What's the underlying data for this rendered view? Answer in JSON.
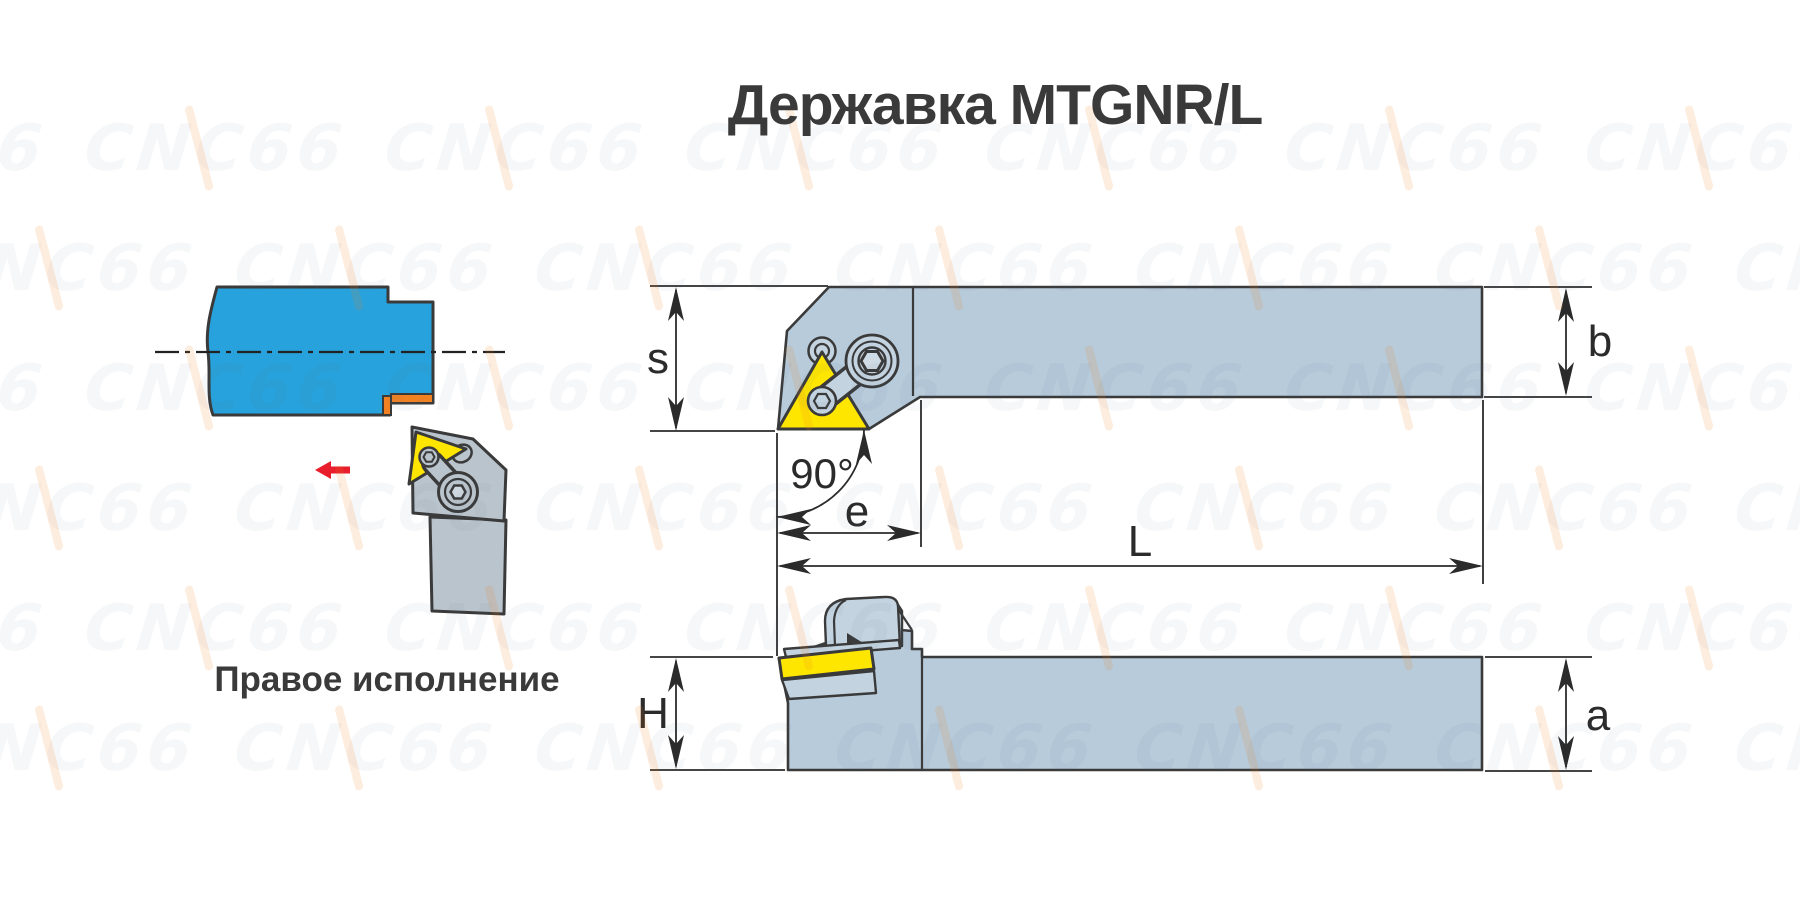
{
  "title": "Державка MTGNR/L",
  "caption": "Правое исполнение",
  "watermark": {
    "text": "CNC66"
  },
  "labels": {
    "s": "s",
    "b": "b",
    "angle": "90°",
    "e": "e",
    "L": "L",
    "H": "H",
    "a": "a"
  },
  "colors": {
    "outline": "#3a3a3a",
    "dim": "#2b2b2b",
    "drawing_fill": "#b7cbdb",
    "drawing_fill2": "#c3d3e0",
    "tool_gray": "#bac4cd",
    "workpiece_blue": "#27a2dc",
    "chip_orange": "#f28121",
    "insert_yellow": "#ffe600",
    "arrow_red": "#e81e2c",
    "text": "#3a3a3a"
  }
}
